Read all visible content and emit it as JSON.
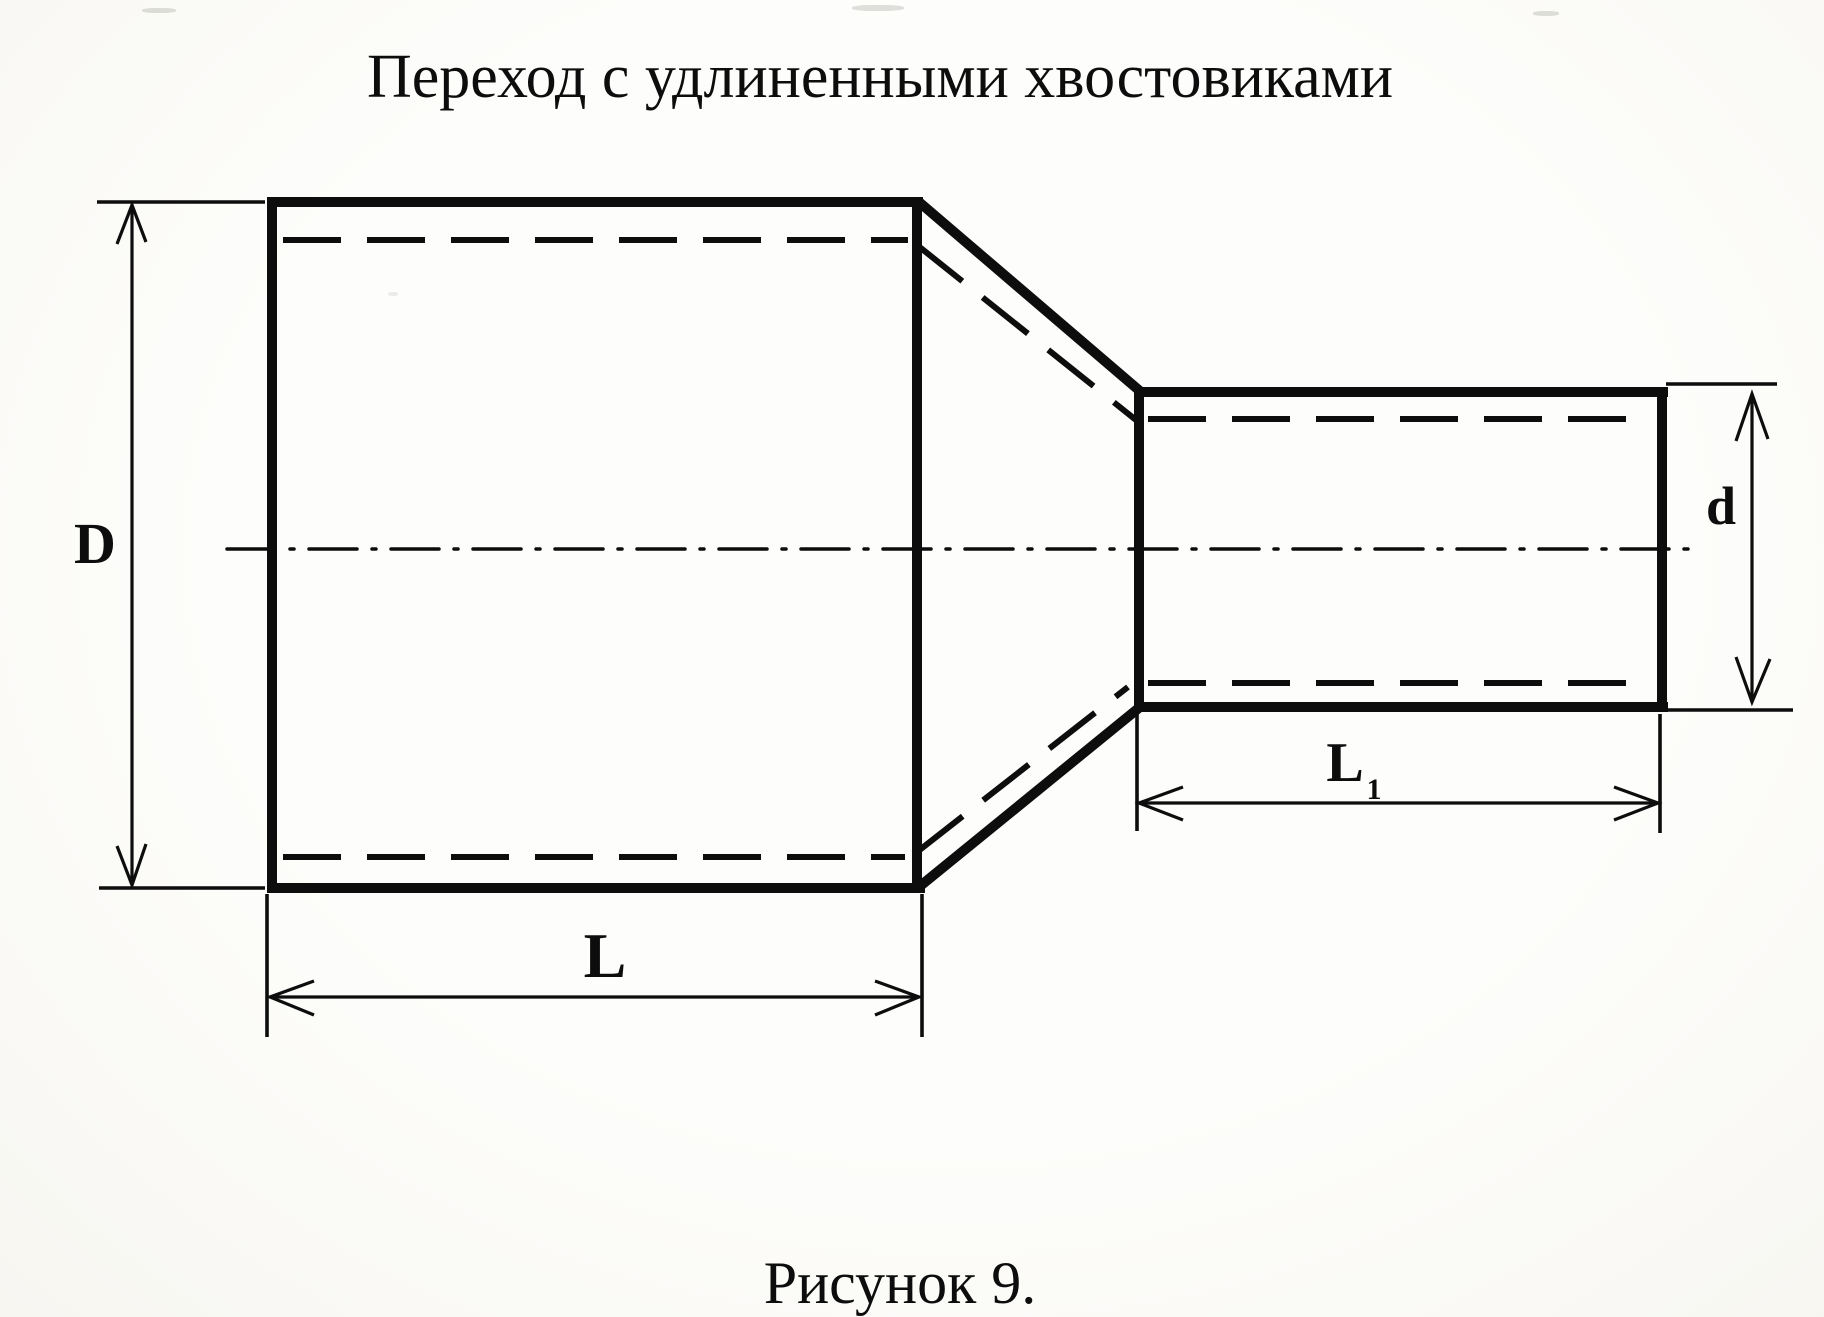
{
  "title": "Переход с удлиненными хвостовиками",
  "caption": "Рисунок 9.",
  "colors": {
    "ink": "#0d0d0d",
    "paper": "#fcfbf8"
  },
  "dimension_labels": {
    "large_diameter": "D",
    "large_length": "L",
    "small_length": {
      "base": "L",
      "subscript": "1"
    },
    "small_diameter": "d"
  }
}
